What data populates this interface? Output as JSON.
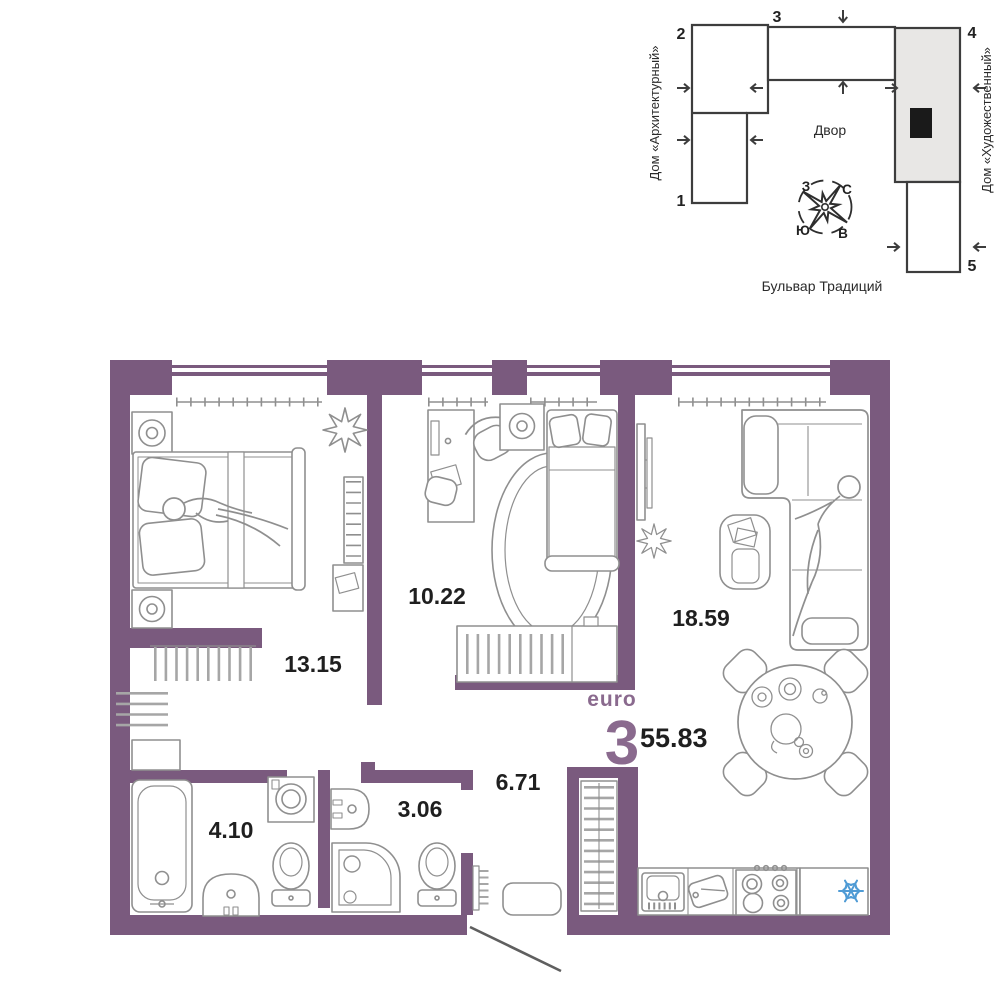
{
  "unit": {
    "type_label": "euro",
    "rooms_count": "3",
    "total_area": "55.83"
  },
  "floor_plan": {
    "rooms": [
      {
        "name": "bedroom",
        "area": "13.15"
      },
      {
        "name": "bedroom-2",
        "area": "10.22"
      },
      {
        "name": "living-kitchen",
        "area": "18.59"
      },
      {
        "name": "hallway",
        "area": "6.71"
      },
      {
        "name": "bathroom",
        "area": "4.10"
      },
      {
        "name": "toilet",
        "area": "3.06"
      }
    ]
  },
  "site_plan": {
    "house_left": "Дом «Архитектурный»",
    "house_right": "Дом «Художественный»",
    "courtyard": "Двор",
    "street": "Бульвар Традиций",
    "building_numbers": [
      "1",
      "2",
      "3",
      "4",
      "5"
    ],
    "compass": {
      "north": "С",
      "south": "Ю",
      "west": "З",
      "east": "В"
    }
  },
  "colors": {
    "wall": "#7a5a7e",
    "accent": "#8a6a8e",
    "outline": "#3d3d3d",
    "furniture": "#8f8f8f",
    "text": "#1f1f1f",
    "snowflake": "#4f9bd5"
  }
}
